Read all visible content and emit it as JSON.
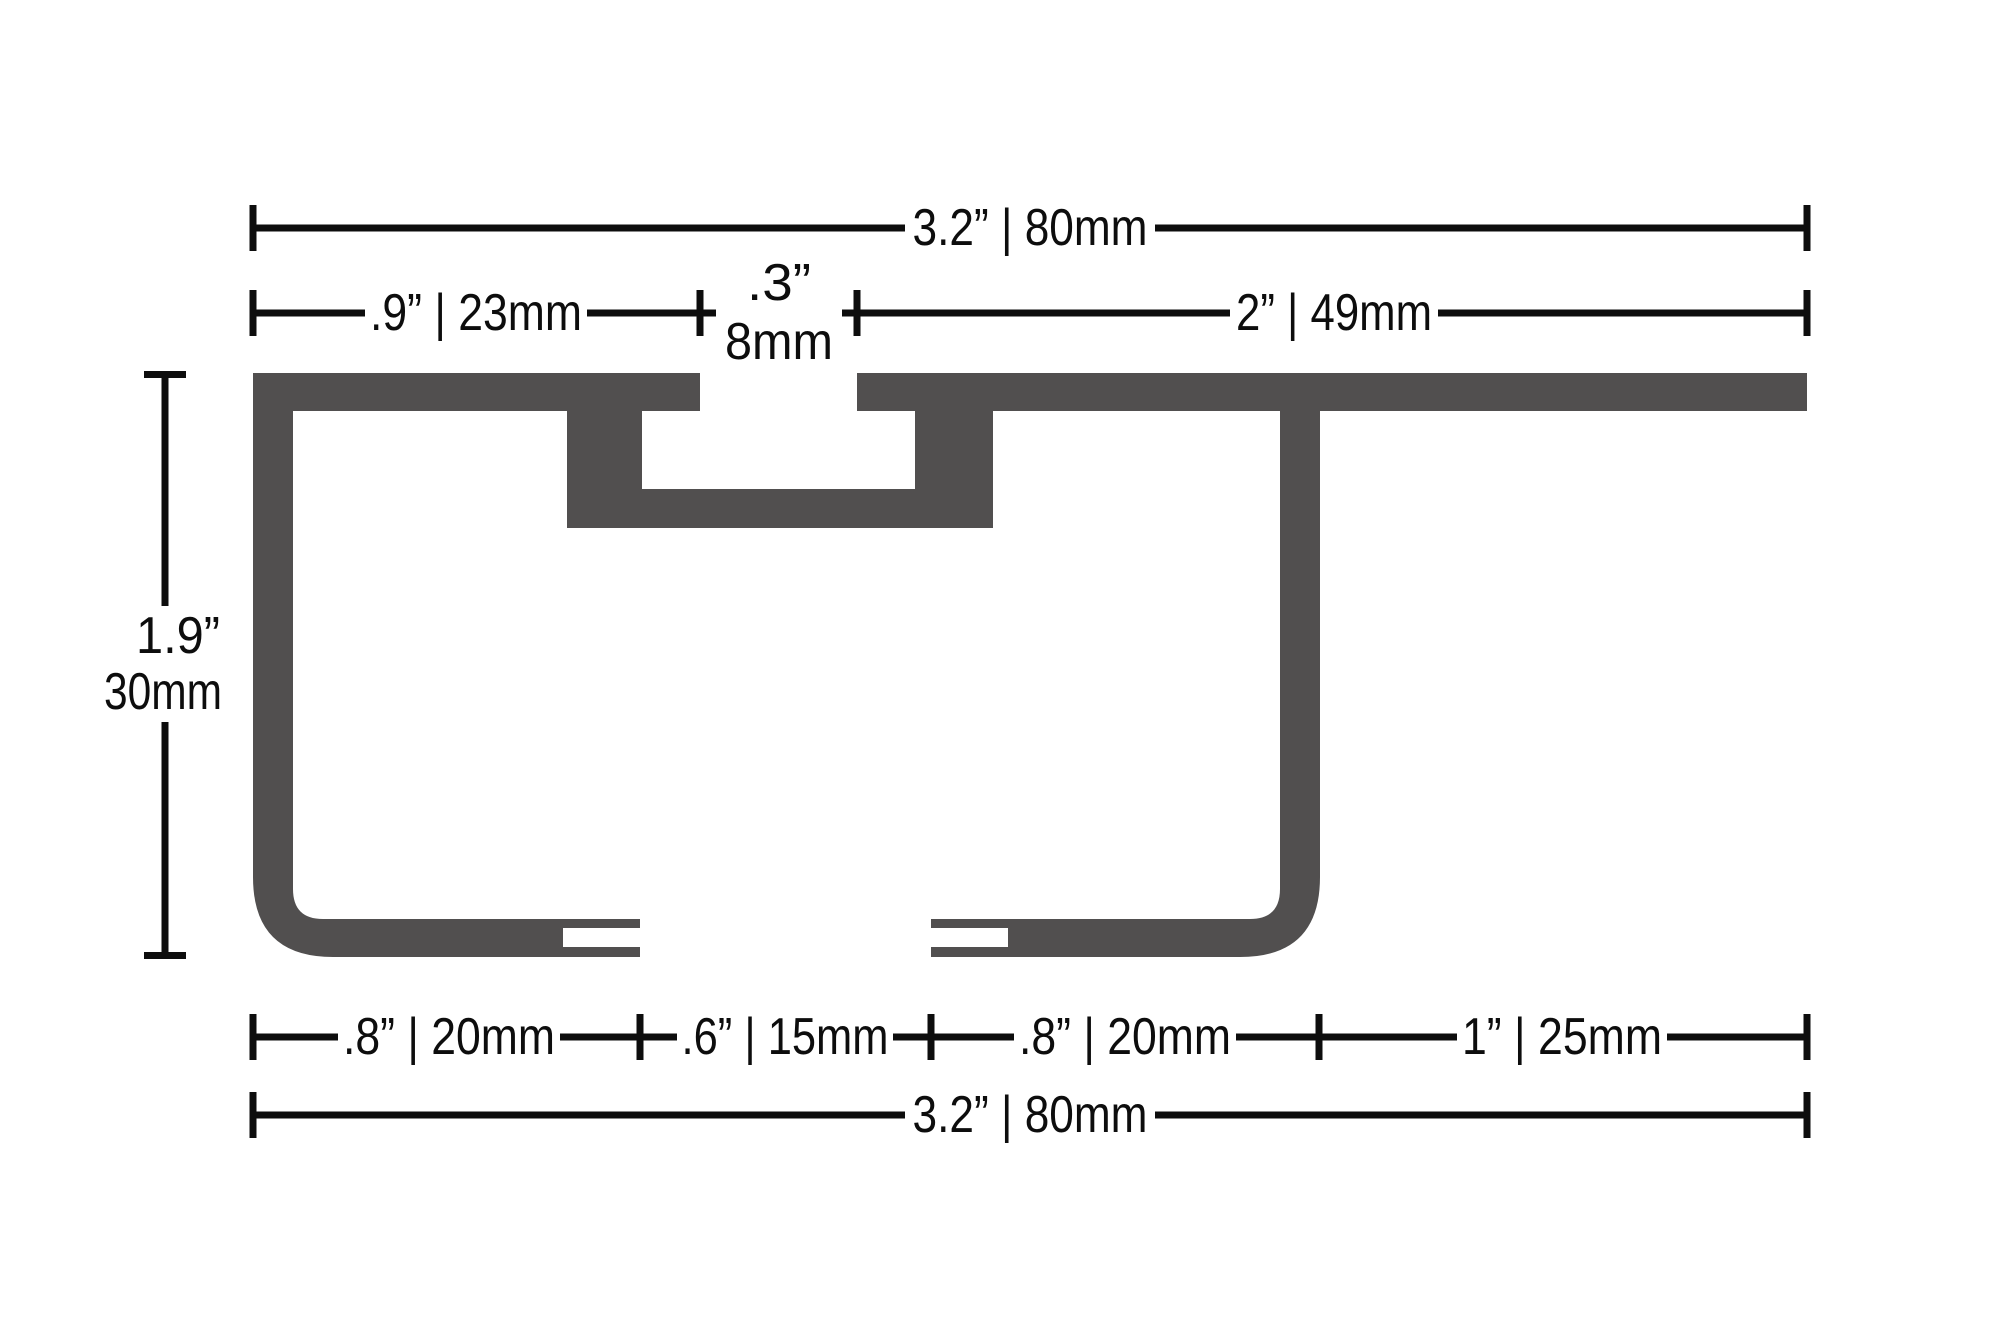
{
  "colors": {
    "profile": "#514F4F",
    "dimension": "#0D0D0D",
    "background": "#FFFFFF"
  },
  "dimensions": {
    "top_overall": "3.2” | 80mm",
    "flange_left": ".9” | 23mm",
    "slot_inches": ".3”",
    "slot_mm": "8mm",
    "flange_right": "2” | 49mm",
    "height_inches": "1.9”",
    "height_mm": "30mm",
    "bottom_left_flange": ".8” | 20mm",
    "bottom_gap": ".6” | 15mm",
    "bottom_right_flange": ".8” | 20mm",
    "bottom_right_offset": "1” | 25mm",
    "bottom_overall": "3.2” | 80mm"
  }
}
